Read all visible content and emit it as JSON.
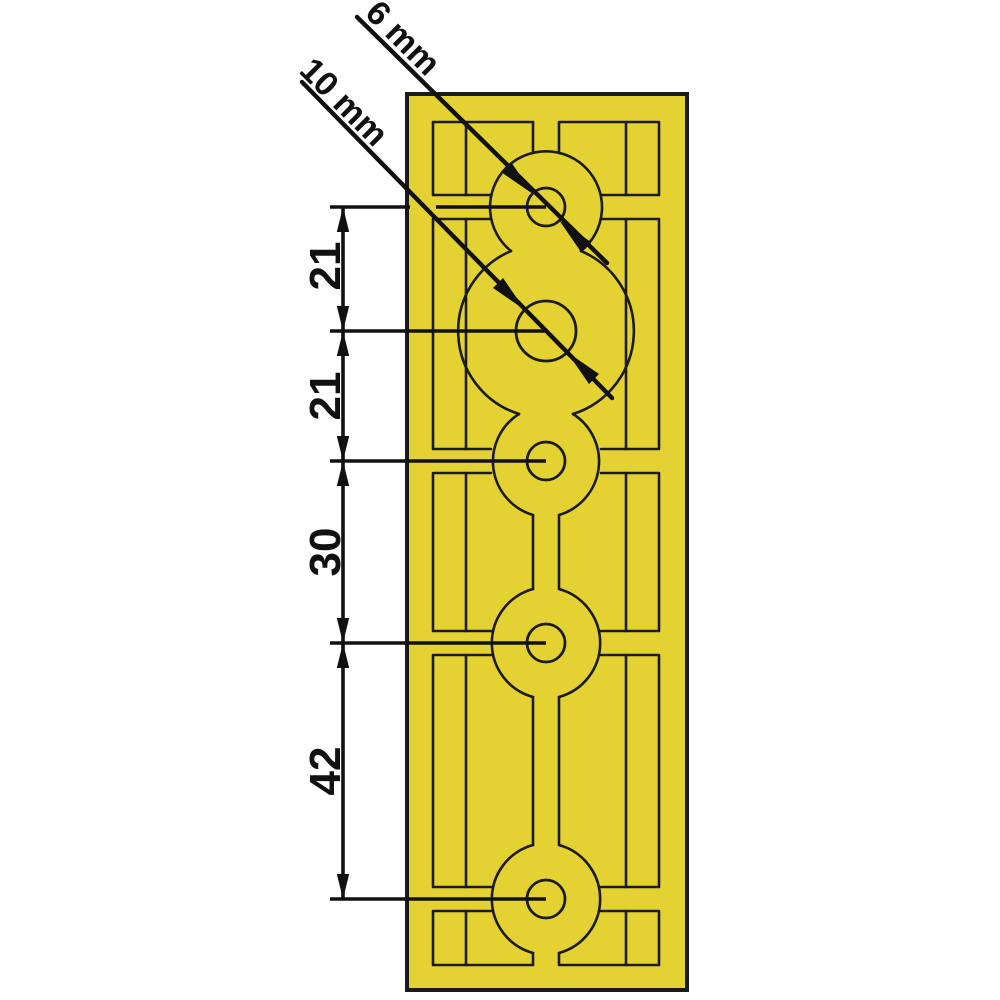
{
  "figure": {
    "type": "technical-dimension-drawing",
    "part": "perforated mounting plate with cable grooves",
    "hole_labels": {
      "small_hole_diameter": "6 mm",
      "large_hole_diameter": "10 mm"
    },
    "dimensions": [
      "21",
      "21",
      "30",
      "42"
    ],
    "colors": {
      "plate_fill": "#e4d233",
      "groove_line": "#1b1b1b",
      "dimension_line": "#111111",
      "background": "#ffffff"
    }
  }
}
